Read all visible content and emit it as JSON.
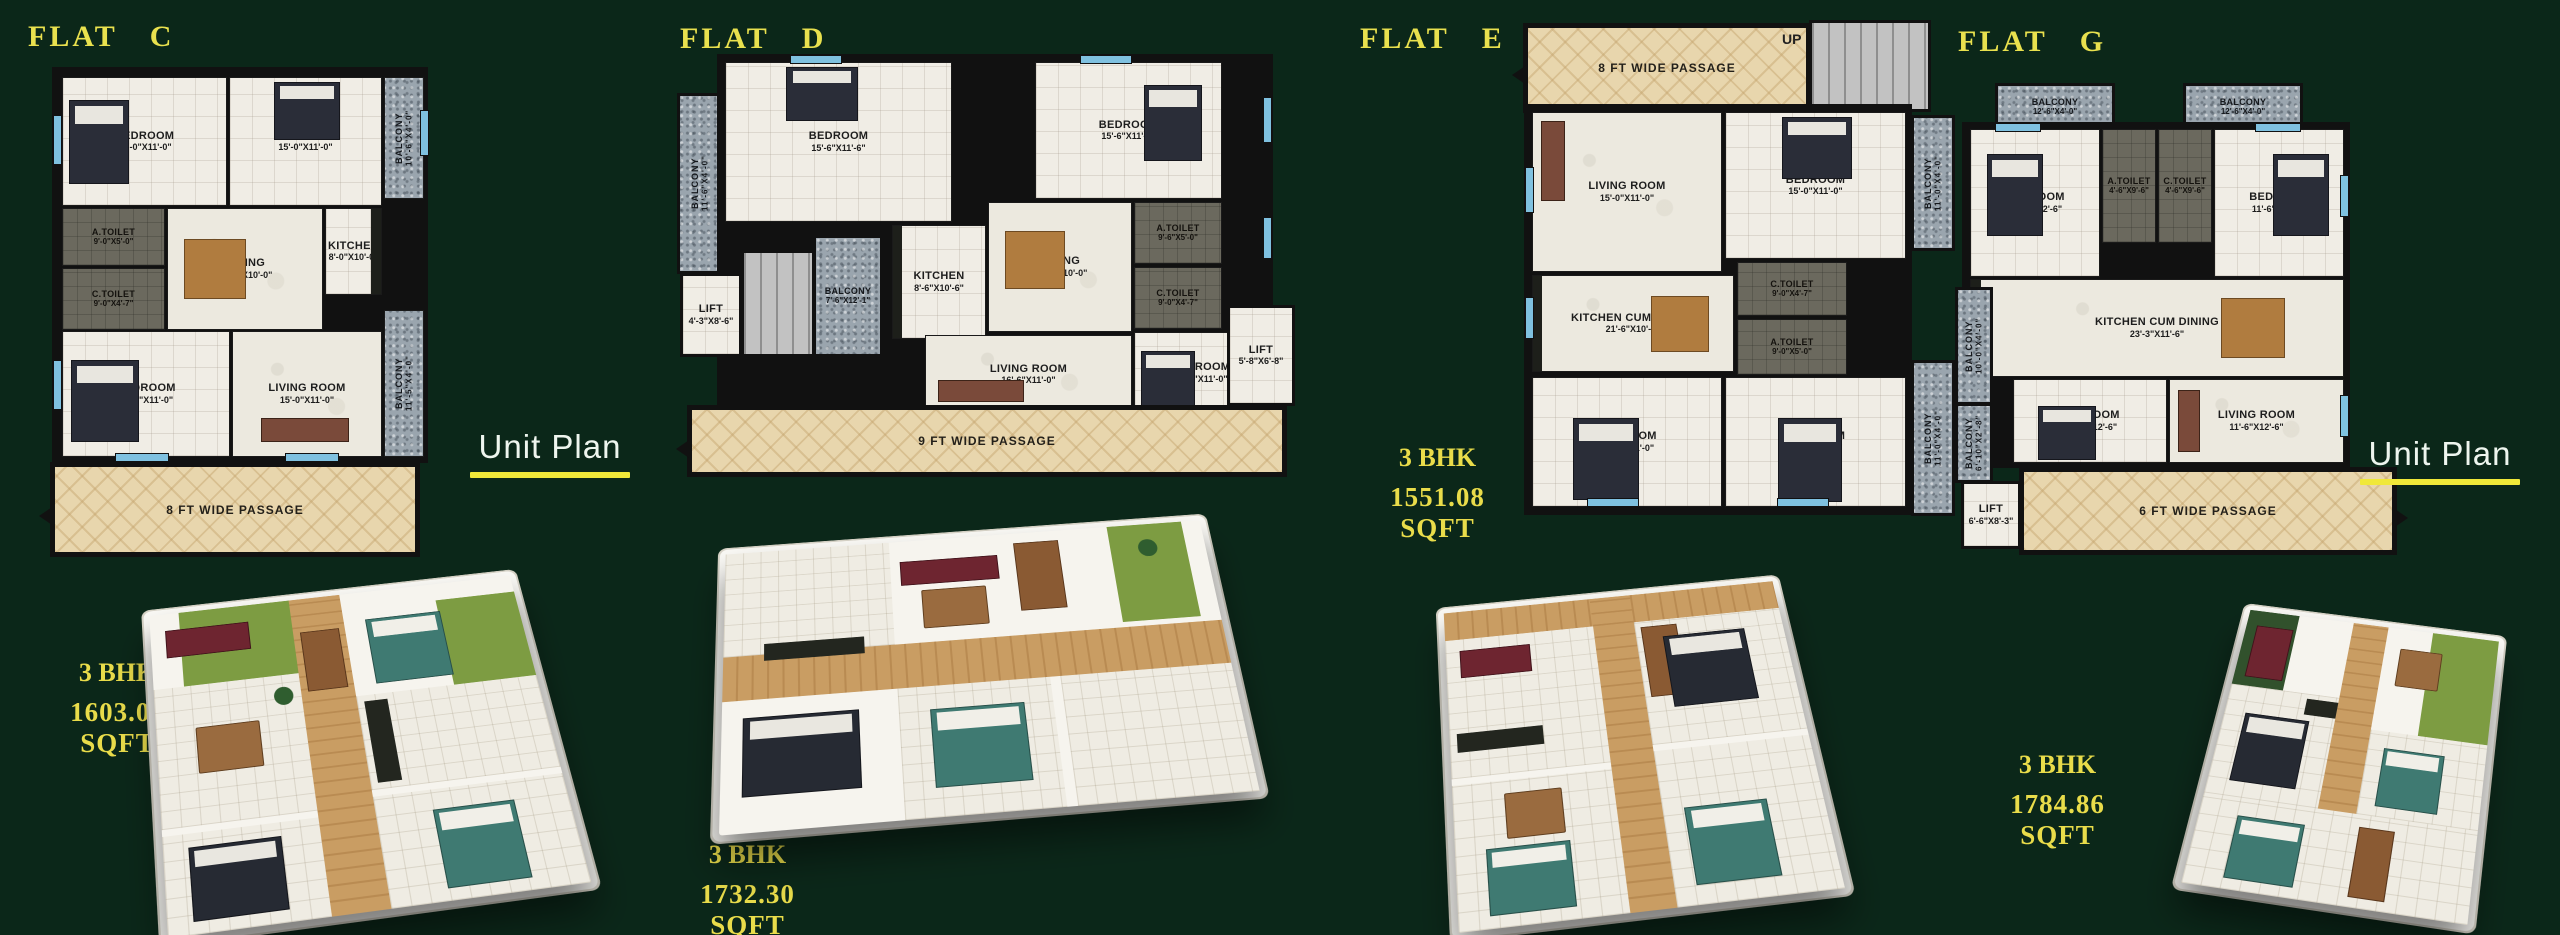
{
  "background_color": "#0b2719",
  "colors": {
    "title_yellow": "#e9e14e",
    "spec_yellow": "#e9dc4a",
    "unit_plan_text": "#eef5ee",
    "unit_plan_underline": "#f0e839",
    "plan_wall_black": "#111111",
    "plan_floor": "#edeae2",
    "toilet_gray": "#6b695e",
    "balcony_gray": "#9aa5ae",
    "passage_beige": "#e8d6ad",
    "window_blue": "#7fc1e0",
    "render_wood": "#c99d63",
    "render_accent_green": "#7d9c42"
  },
  "unit_plan": {
    "left": "Unit Plan",
    "right": "Unit Plan"
  },
  "flats": [
    {
      "id": "C",
      "title": "FLAT C",
      "spec": {
        "bhk": "3 BHK",
        "area": "1603.08 SQFT"
      },
      "passage": "8 FT WIDE PASSAGE",
      "rooms": [
        {
          "name": "BEDROOM",
          "dim": "15'-0\"X11'-0\""
        },
        {
          "name": "BEDROOM",
          "dim": "15'-0\"X11'-0\""
        },
        {
          "name": "BALCONY",
          "dim": "10'-6\"X4'-0\""
        },
        {
          "name": "A.TOILET",
          "dim": "9'-0\"X5'-0\""
        },
        {
          "name": "C.TOILET",
          "dim": "9'-0\"X4'-7\""
        },
        {
          "name": "DINING",
          "dim": "16'-7\"X10'-0\""
        },
        {
          "name": "KITCHEN",
          "dim": "8'-0\"X10'-0\""
        },
        {
          "name": "BEDROOM",
          "dim": "15'-0\"X11'-0\""
        },
        {
          "name": "LIVING ROOM",
          "dim": "15'-0\"X11'-0\""
        },
        {
          "name": "BALCONY",
          "dim": "11'-5\"X4'-0\""
        }
      ]
    },
    {
      "id": "D",
      "title": "FLAT D",
      "spec": {
        "bhk": "3 BHK",
        "area": "1732.30 SQFT"
      },
      "passage": "9 FT WIDE PASSAGE",
      "rooms": [
        {
          "name": "BALCONY",
          "dim": "11'-6\"X4'-0\""
        },
        {
          "name": "BEDROOM",
          "dim": "15'-6\"X11'-6\""
        },
        {
          "name": "BEDROOM",
          "dim": "15'-6\"X11'-0\""
        },
        {
          "name": "KITCHEN",
          "dim": "8'-6\"X10'-6\""
        },
        {
          "name": "DINING",
          "dim": "16'-7\"X10'-0\""
        },
        {
          "name": "A.TOILET",
          "dim": "9'-6\"X5'-0\""
        },
        {
          "name": "C.TOILET",
          "dim": "9'-0\"X4'-7\""
        },
        {
          "name": "LIVING ROOM",
          "dim": "16'-6\"X11'-0\""
        },
        {
          "name": "BEDROOM",
          "dim": "15'-6\"X11'-0\""
        },
        {
          "name": "LIFT",
          "dim": "4'-3\"X8'-6\""
        },
        {
          "name": "BALCONY",
          "dim": "7'-6\"X12'-1\""
        },
        {
          "name": "LIFT",
          "dim": "5'-8\"X6'-8\""
        }
      ]
    },
    {
      "id": "E",
      "title": "FLAT E",
      "spec": {
        "bhk": "3 BHK",
        "area": "1551.08 SQFT"
      },
      "passage": "8 FT WIDE PASSAGE",
      "stairs_label": "UP",
      "rooms": [
        {
          "name": "LIVING ROOM",
          "dim": "15'-0\"X11'-0\""
        },
        {
          "name": "BEDROOM",
          "dim": "15'-0\"X11'-0\""
        },
        {
          "name": "BALCONY",
          "dim": "11'-0\"X4'-0\""
        },
        {
          "name": "KITCHEN CUM DINING",
          "dim": "21'-6\"X10'-6\""
        },
        {
          "name": "C.TOILET",
          "dim": "9'-0\"X4'-7\""
        },
        {
          "name": "A.TOILET",
          "dim": "9'-0\"X5'-0\""
        },
        {
          "name": "BEDROOM",
          "dim": "15'-0\"X11'-0\""
        },
        {
          "name": "BEDROOM",
          "dim": "15'-0\"X11'-0\""
        },
        {
          "name": "BALCONY",
          "dim": "11'-0\"X4'-0\""
        }
      ]
    },
    {
      "id": "G",
      "title": "FLAT G",
      "spec": {
        "bhk": "3 BHK",
        "area": "1784.86  SQFT"
      },
      "passage": "6 FT WIDE PASSAGE",
      "rooms": [
        {
          "name": "BALCONY",
          "dim": "12'-6\"X4'-0\""
        },
        {
          "name": "BALCONY",
          "dim": "12'-6\"X4'-0\""
        },
        {
          "name": "BEDROOM",
          "dim": "11'-6\"X12'-6\""
        },
        {
          "name": "A.TOILET",
          "dim": "4'-6\"X9'-6\""
        },
        {
          "name": "C.TOILET",
          "dim": "4'-6\"X9'-6\""
        },
        {
          "name": "BEDROOM",
          "dim": "11'-6\"X12'-6\""
        },
        {
          "name": "KITCHEN CUM DINING",
          "dim": "23'-3\"X11'-6\""
        },
        {
          "name": "BALCONY",
          "dim": "10'-0\"X4'-0\""
        },
        {
          "name": "BEDROOM",
          "dim": "11'-6\"X12'-6\""
        },
        {
          "name": "LIVING ROOM",
          "dim": "11'-6\"X12'-6\""
        },
        {
          "name": "BALCONY",
          "dim": "6'-10\"X2'-8\""
        },
        {
          "name": "LIFT",
          "dim": "6'-6\"X8'-3\""
        }
      ]
    }
  ]
}
